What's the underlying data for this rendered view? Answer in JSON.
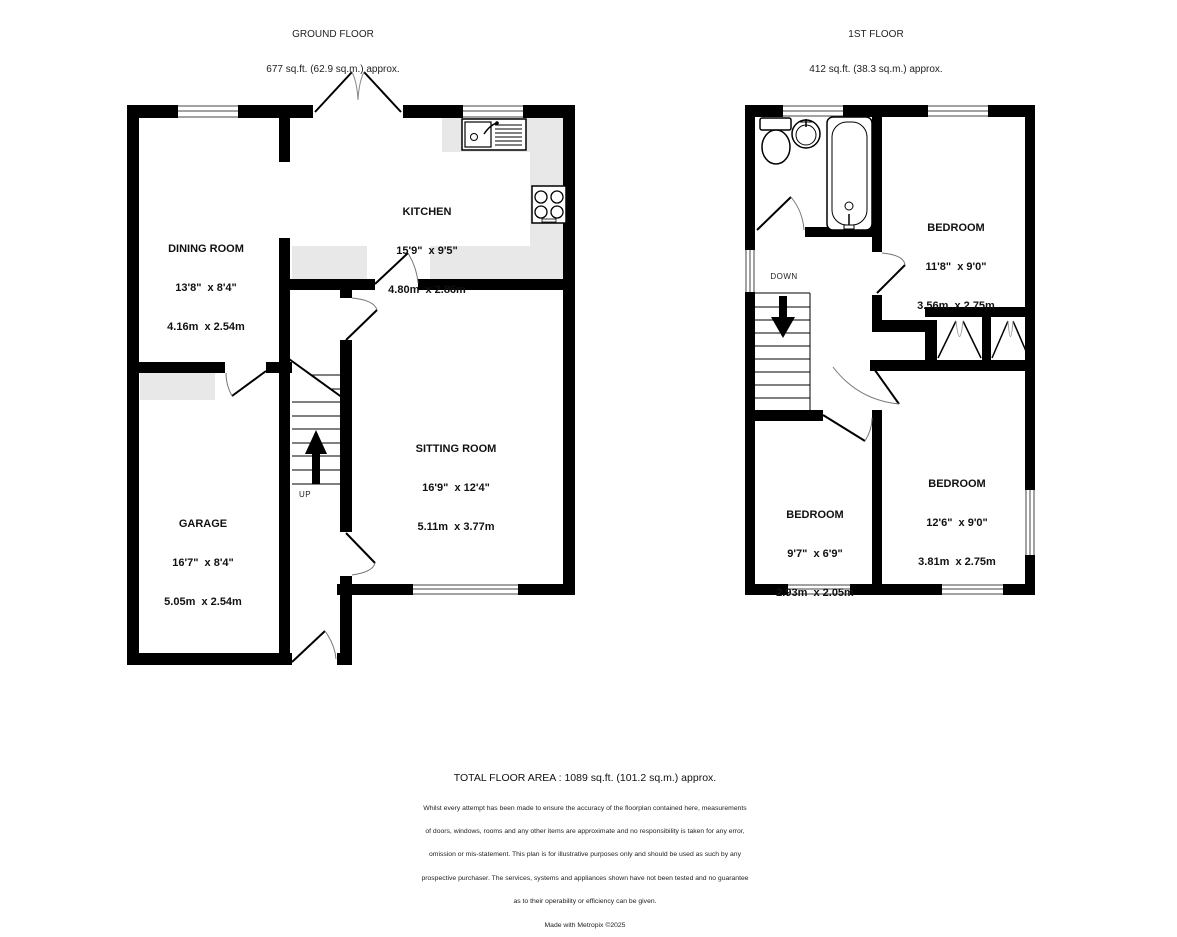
{
  "ground_floor": {
    "title": "GROUND FLOOR",
    "area": "677 sq.ft. (62.9 sq.m.) approx.",
    "stairs_label": "UP",
    "rooms": [
      {
        "name": "DINING ROOM",
        "imperial": "13'8\"  x 8'4\"",
        "metric": "4.16m  x 2.54m"
      },
      {
        "name": "KITCHEN",
        "imperial": "15'9\"  x 9'5\"",
        "metric": "4.80m  x 2.86m"
      },
      {
        "name": "SITTING ROOM",
        "imperial": "16'9\"  x 12'4\"",
        "metric": "5.11m  x 3.77m"
      },
      {
        "name": "GARAGE",
        "imperial": "16'7\"  x 8'4\"",
        "metric": "5.05m  x 2.54m"
      }
    ]
  },
  "first_floor": {
    "title": "1ST FLOOR",
    "area": "412 sq.ft. (38.3 sq.m.) approx.",
    "stairs_label": "DOWN",
    "rooms": [
      {
        "name": "BEDROOM",
        "imperial": "11'8\"  x 9'0\"",
        "metric": "3.56m  x 2.75m"
      },
      {
        "name": "BEDROOM",
        "imperial": "12'6\"  x 9'0\"",
        "metric": "3.81m  x 2.75m"
      },
      {
        "name": "BEDROOM",
        "imperial": "9'7\"  x 6'9\"",
        "metric": "2.93m  x 2.05m"
      }
    ]
  },
  "footer": {
    "total_area": "TOTAL FLOOR AREA : 1089 sq.ft. (101.2 sq.m.) approx.",
    "disclaimer_lines": [
      "Whilst every attempt has been made to ensure the accuracy of the floorplan contained here, measurements",
      "of doors, windows, rooms and any other items are approximate and no responsibility is taken for any error,",
      "omission or mis-statement. This plan is for illustrative purposes only and should be used as such by any",
      "prospective purchaser. The services, systems and appliances shown have not been tested and no guarantee",
      "as to their operability or efficiency can be given."
    ],
    "credit": "Made with Metropix ©2025"
  },
  "colors": {
    "wall": "#000000",
    "counter": "#e8e8e8",
    "background": "#ffffff"
  }
}
